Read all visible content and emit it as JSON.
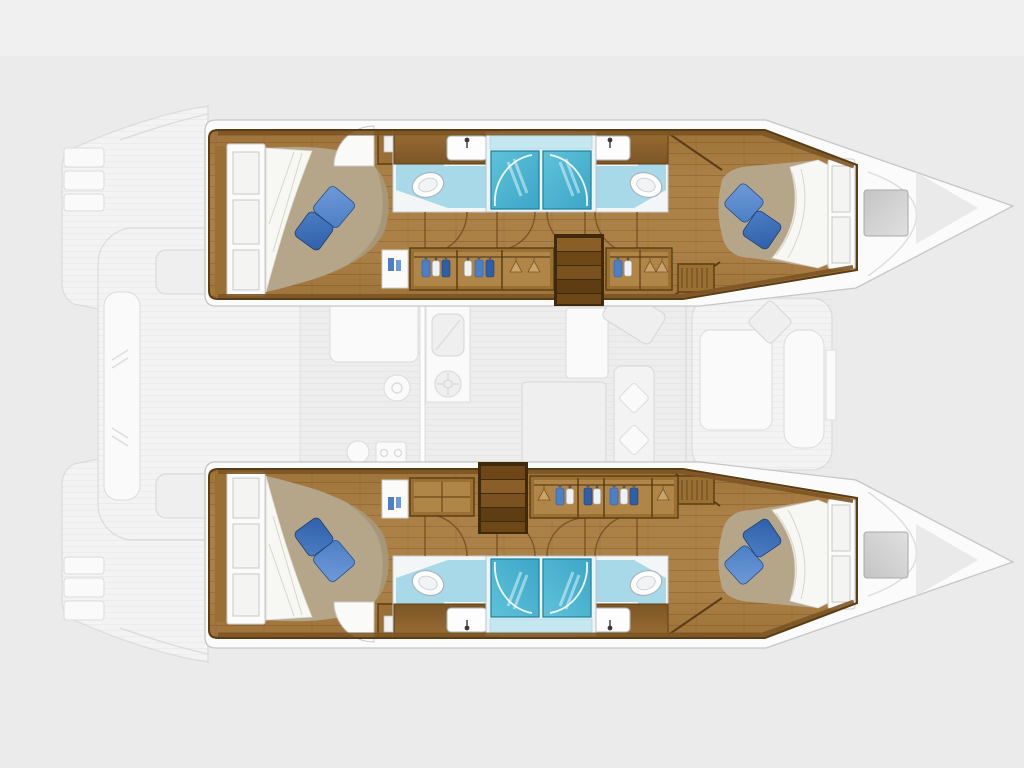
{
  "canvas": {
    "width": 1024,
    "height": 768,
    "background": "#ebebeb"
  },
  "palette": {
    "background": "#ebebeb",
    "top_band": "#f0f0f0",
    "deck": "#fbfbfb",
    "deck_line": "#c6c6c6",
    "ghost_fill": "#f3f3f3",
    "ghost_line": "#dcdcdc",
    "wood_floor": "#ab8148",
    "wood_floor_edge": "#9c7238",
    "wood_trim": "#7c5526",
    "wood_dark": "#5a3d12",
    "cabinet": "#9a6f33",
    "cabinet_face": "#b08548",
    "stair_dark": "#3f2a0c",
    "tread_a": "#8a5e27",
    "tread_b": "#6d4716",
    "tread_c": "#7a5220",
    "tread_d": "#5f3d12",
    "blanket": "#b5a68a",
    "sheet": "#f7f7f4",
    "pillow_dark": "#2e5fa8",
    "pillow_dark_edge": "#24508f",
    "pillow_mid": "#4c7ec5",
    "pillow_light": "#6f9ad8",
    "bath_wall": "#f3f6f7",
    "bath_floor": "#a7d9e8",
    "shower_top": "#c5e7f0",
    "shower_a": "#5fc2da",
    "shower_b": "#3ba6c6",
    "shower_line": "#1f86a4",
    "fixture": "#fdfdfd",
    "fixture_line": "#a9b3b8",
    "clothes_blue": "#4d7fc4",
    "clothes_blue_dark": "#2e5fa8",
    "clothes_white": "#eef1f5",
    "clothes_tan": "#caa36a",
    "hatch_a": "#c4c4c4",
    "hatch_b": "#e0e0e0",
    "faucet": "#3a3a3a"
  },
  "vessel": {
    "type": "catamaran-deck-plan",
    "orientation": "bows-right",
    "hulls": [
      {
        "id": "port-hull",
        "position": "top",
        "rooms": [
          "aft-double-cabin",
          "aft-head-with-shower",
          "forward-head-with-shower",
          "forward-double-cabin"
        ],
        "fixtures": {
          "toilets": 2,
          "sinks": 2,
          "shower-stalls": 2,
          "wardrobes": 2,
          "companionway-steps": 5,
          "pillows-per-bed": 2
        }
      },
      {
        "id": "starboard-hull",
        "position": "bottom",
        "rooms": [
          "aft-double-cabin",
          "aft-head-with-shower",
          "forward-head-with-shower",
          "forward-double-cabin"
        ],
        "fixtures": {
          "toilets": 2,
          "sinks": 2,
          "shower-stalls": 2,
          "wardrobes": 2,
          "companionway-steps": 5,
          "pillows-per-bed": 2
        }
      }
    ],
    "bridgedeck": {
      "ghosted": true,
      "zones": [
        "stern-platform-steps",
        "aft-cockpit-bench",
        "salon",
        "galley-sink",
        "galley-stove",
        "galley-fridge",
        "dining-table",
        "nav-seat",
        "forward-cockpit-lounge",
        "foredeck-hatch",
        "trampoline-bows"
      ]
    }
  }
}
